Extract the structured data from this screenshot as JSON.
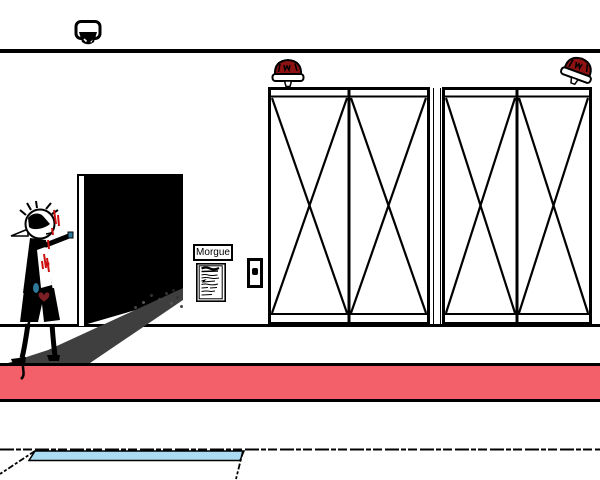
{
  "scene": {
    "label": "morgue-hallway",
    "sign_label": "Morgue",
    "colors": {
      "wall_white": "#ffffff",
      "outline_black": "#000000",
      "floor_stripe_red": "#f4606a",
      "puddle_blue": "#abdcf2",
      "ramp_shadow_gray": "#3f3f3f",
      "alarm_dome_red": "#8e1212",
      "blood_red": "#cc1111",
      "heart_dark_red": "#7c2025",
      "sleeve_blue": "#2e7899"
    },
    "objects": {
      "camera": "security-camera",
      "alarm_left": "alarm-light",
      "alarm_right": "alarm-light-tilted",
      "doorway": "dark-open-doorway",
      "sign": "morgue-sign",
      "paper": "posted-notice",
      "button": "door-call-button",
      "door_left": "crossbrace-freezer-door",
      "door_right": "crossbrace-freezer-door",
      "character": "injured-character-pointing",
      "ramp": "shadow-ramp",
      "stripe": "red-floor-stripe",
      "puddle": "blue-floor-puddle"
    }
  }
}
